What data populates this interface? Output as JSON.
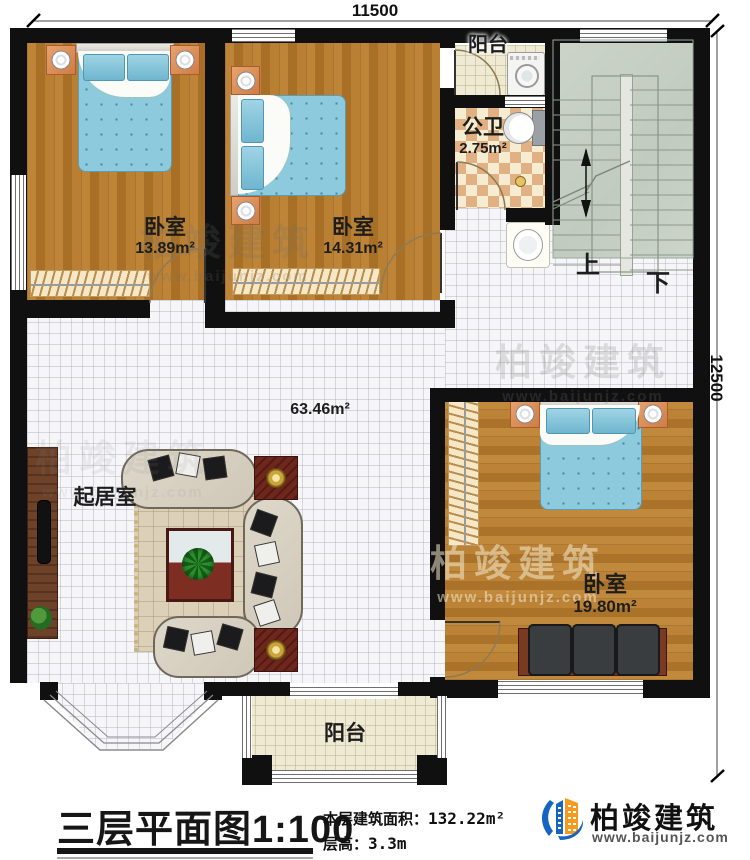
{
  "dimensions": {
    "top": "11500",
    "right": "12500"
  },
  "rooms": {
    "bedroom1": {
      "label": "卧室",
      "area": "13.89m²"
    },
    "bedroom2": {
      "label": "卧室",
      "area": "14.31m²"
    },
    "bathroom": {
      "label": "公卫",
      "area": "2.75m²"
    },
    "balcony_top": {
      "label": "阳台"
    },
    "living": {
      "label": "起居室",
      "area": "63.46m²"
    },
    "bedroom3": {
      "label": "卧室",
      "area": "19.80m²"
    },
    "balcony_bottom": {
      "label": "阳台"
    }
  },
  "stairs": {
    "up": "上",
    "down": "下"
  },
  "footer": {
    "title": "三层平面图",
    "scale": "1:100",
    "area_label": "本层建筑面积：",
    "area_value": "132.22m²",
    "floor_height_label": "层高：",
    "floor_height_value": "3.3m"
  },
  "brand": {
    "name": "柏竣建筑",
    "url": "www.baijunjz.com"
  },
  "watermark": {
    "name": "柏竣建筑",
    "url": "www.baijunjz.com"
  }
}
